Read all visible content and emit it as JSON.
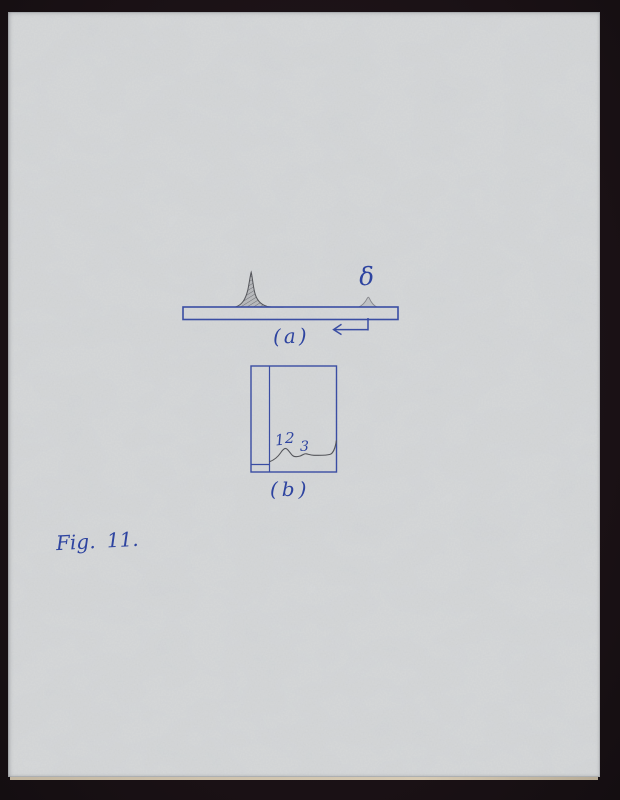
{
  "scene": {
    "background_color": "#1d1418",
    "paper_color": "#d7d9da",
    "paper_edge_color": "#cdc1ac",
    "ink_color": "#3a4da3",
    "ink_text_color": "#2e44a0",
    "pencil_color": "#54555a"
  },
  "figure_a": {
    "label": "(a)",
    "delta_label": "δ"
  },
  "figure_b": {
    "label": "(b)",
    "spot_labels": [
      "1",
      "2",
      "3"
    ]
  },
  "caption": "Fig. 11."
}
